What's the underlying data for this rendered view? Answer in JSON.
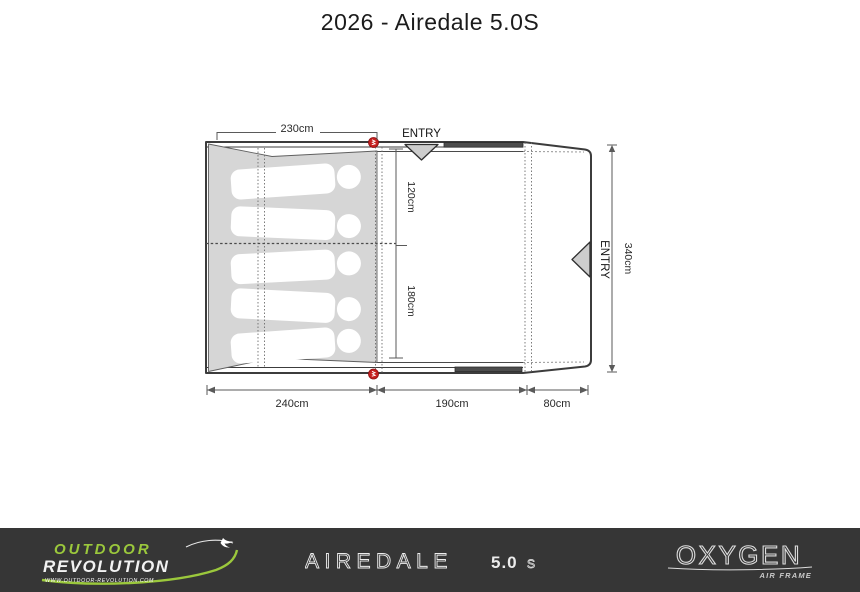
{
  "title": "2026 - Airedale 5.0S",
  "plan": {
    "entry_top": "ENTRY",
    "entry_right": "ENTRY",
    "dim_230": "230cm",
    "dim_120": "120cm",
    "dim_180": "180cm",
    "dim_340": "340cm",
    "dim_240": "240cm",
    "dim_190": "190cm",
    "dim_80": "80cm"
  },
  "footer": {
    "brand_line1": "OUTDOOR",
    "brand_line2": "REVOLUTION",
    "brand_url": "WWW.OUTDOOR-REVOLUTION.COM",
    "model_name": "AIREDALE",
    "model_size": "5.0",
    "model_variant": "S",
    "frame_brand": "OXYGEN",
    "frame_sub": "AIR FRAME"
  },
  "colors": {
    "accent_green": "#9bc83c",
    "marker_red": "#c5201f",
    "footer_bg": "#363636",
    "bedroom_gray": "#d6d6d6"
  }
}
